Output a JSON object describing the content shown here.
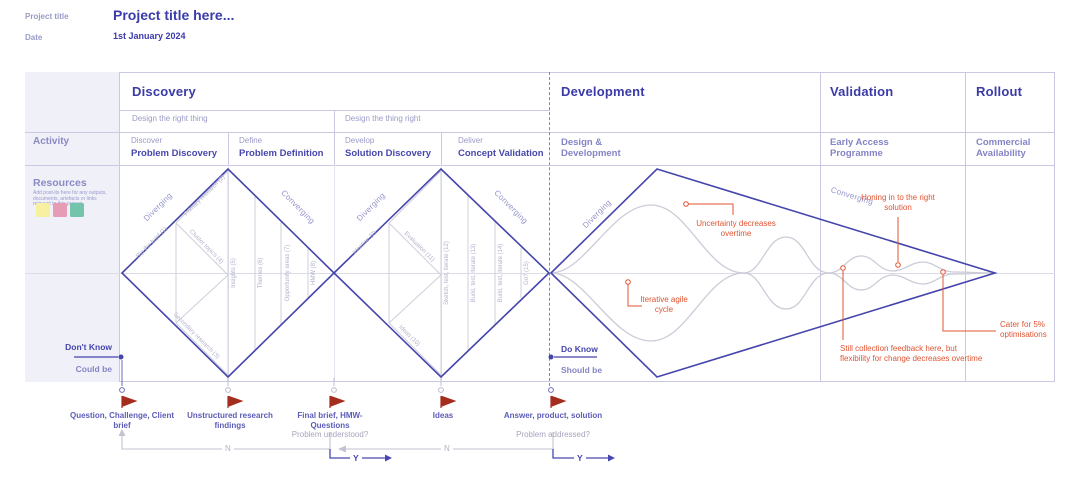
{
  "header": {
    "project_title_label": "Project title",
    "project_title_value": "Project title here...",
    "date_label": "Date",
    "date_value": "1st January 2024"
  },
  "left_panel": {
    "activity_label": "Activity",
    "resources_label": "Resources",
    "resources_note": "Add post-its here for any outputs, documents, artefacts or links relevant to this project",
    "postit_colors": [
      "#f7f0a0",
      "#e69cb4",
      "#74c3ab"
    ]
  },
  "phases": {
    "discovery": {
      "title": "Discovery",
      "subheaders": [
        {
          "label": "Design the right thing"
        },
        {
          "label": "Design the thing right"
        }
      ],
      "activities": [
        {
          "stage": "Discover",
          "name": "Problem Discovery"
        },
        {
          "stage": "Define",
          "name": "Problem Definition"
        },
        {
          "stage": "Develop",
          "name": "Solution Discovery"
        },
        {
          "stage": "Deliver",
          "name": "Concept Validation"
        }
      ]
    },
    "development": {
      "title": "Development",
      "activity": "Design & Development"
    },
    "validation": {
      "title": "Validation",
      "activity": "Early Access Programme"
    },
    "rollout": {
      "title": "Rollout",
      "activity": "Commercial Availability"
    }
  },
  "diamond1": {
    "diverging": "Diverging",
    "converging": "Converging",
    "steps": [
      "Rip the brief (1)",
      "Primary research (2)",
      "Secondary research (3)",
      "Cluster topics (4)",
      "Insights (5)",
      "Themes (6)",
      "Opportunity areas (7)",
      "HMW (8)"
    ]
  },
  "diamond2": {
    "diverging": "Diverging",
    "converging": "Converging",
    "steps": [
      "Ideation (9)",
      "Ideas (10)",
      "Evaluation (11)",
      "Sketch, test, iterate (12)",
      "Build, test, iterate (13)",
      "Build, test, iterate (14)",
      "Go? (15)"
    ]
  },
  "cone": {
    "diverging": "Diverging",
    "converging": "Converging"
  },
  "annotations": {
    "uncertainty": "Uncertainty decreases overtime",
    "agile": "Iterative agile cycle",
    "honing": "Honing in to the right solution",
    "feedback": "Still collection feedback here, but flexibility for change decreases overtime",
    "cater": "Cater for 5% optimisations"
  },
  "knowledge": {
    "dont_know": "Don't Know",
    "could_be": "Could be",
    "do_know": "Do Know",
    "should_be": "Should be"
  },
  "milestones": [
    {
      "title": "Question, Challenge, Client brief",
      "subtitle": ""
    },
    {
      "title": "Unstructured research findings",
      "subtitle": ""
    },
    {
      "title": "Final brief, HMW-Questions",
      "subtitle": "Problem understood?"
    },
    {
      "title": "Ideas",
      "subtitle": ""
    },
    {
      "title": "Answer, product, solution",
      "subtitle": "Problem addressed?"
    }
  ],
  "flow": {
    "n_label": "N",
    "y_label": "Y"
  },
  "colors": {
    "primary_indigo": "#3a3aa8",
    "grid": "#c9c9e2",
    "annotation_red": "#e05432",
    "flag_red": "#a52d1d"
  }
}
